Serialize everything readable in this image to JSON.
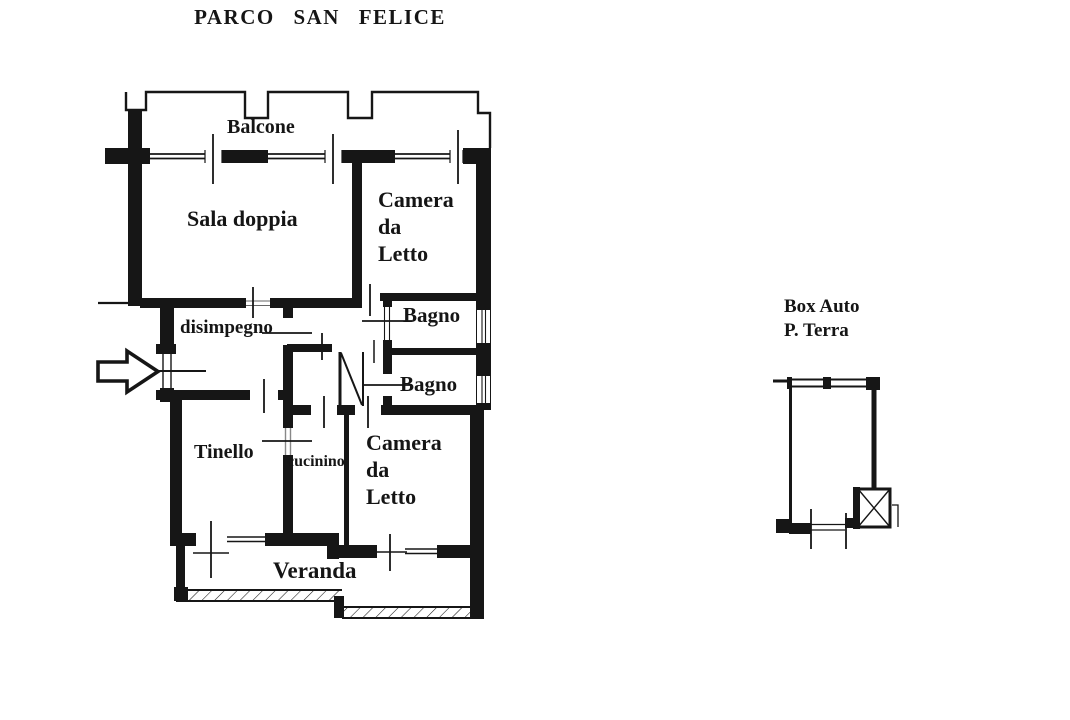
{
  "page": {
    "background": "#ffffff",
    "ink": "#161616"
  },
  "title": "PARCO SAN FELICE",
  "apartment": {
    "labels": {
      "balcone": "Balcone",
      "sala_doppia": "Sala doppia",
      "camera_letto_top": {
        "lines": [
          "Camera",
          "da",
          "Letto"
        ]
      },
      "bagno_top": "Bagno",
      "bagno_bottom": "Bagno",
      "disimpegno": "disimpegno",
      "tinello": "Tinello",
      "cucinino": "cucinino",
      "camera_letto_bottom": {
        "lines": [
          "Camera",
          "da",
          "Letto"
        ]
      },
      "veranda": "Veranda"
    }
  },
  "garage": {
    "labels": {
      "line1": "Box Auto",
      "line2": "P. Terra"
    }
  },
  "icons": {
    "entrance_arrow": "right-outline-arrow",
    "shaft": "crossed-box"
  }
}
